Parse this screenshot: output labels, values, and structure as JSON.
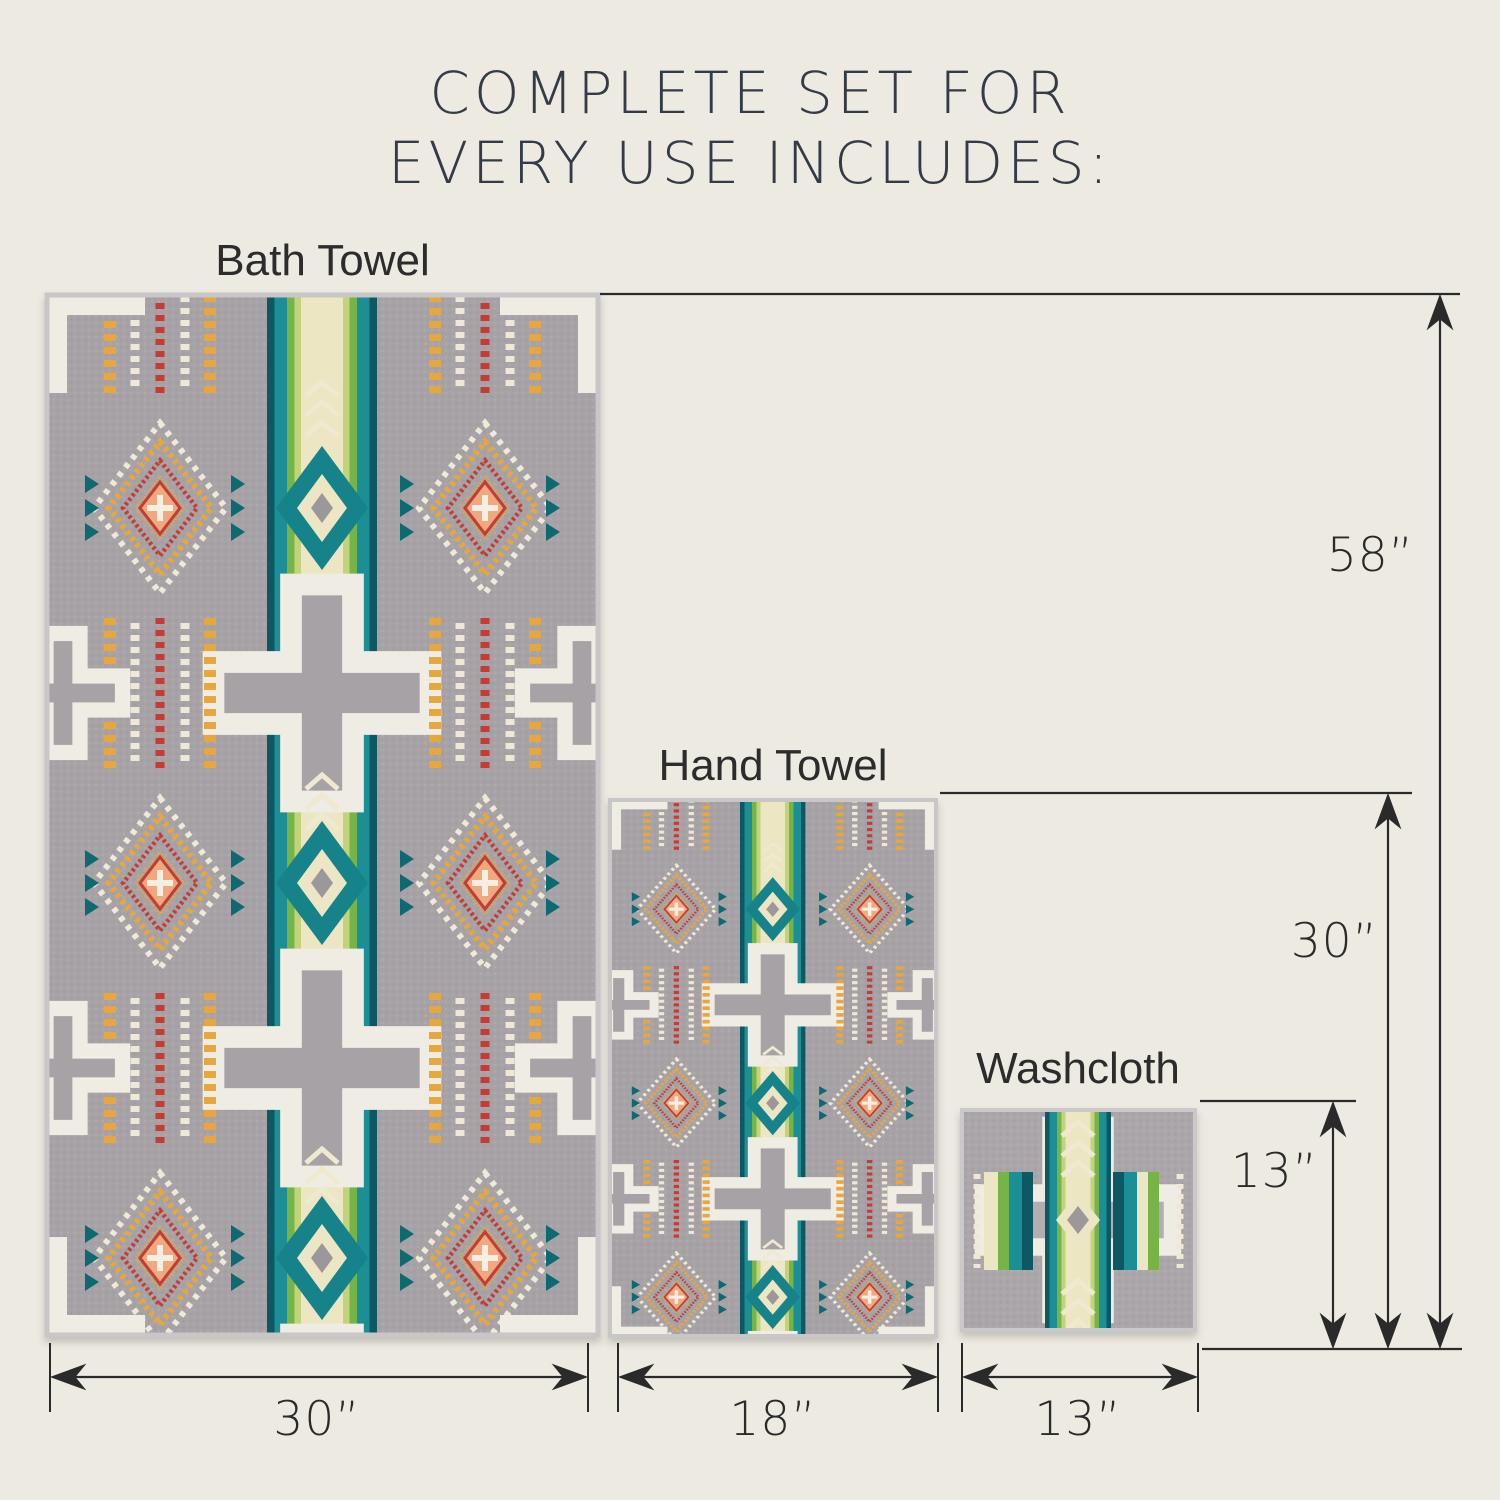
{
  "title": {
    "line1": "COMPLETE SET FOR",
    "line2": "EVERY USE INCLUDES:"
  },
  "items": [
    {
      "name": "Bath Towel",
      "width": "30”",
      "height": "58”"
    },
    {
      "name": "Hand Towel",
      "width": "18”",
      "height": "30”"
    },
    {
      "name": "Washcloth",
      "width": "13”",
      "height": "13”"
    }
  ],
  "palette": {
    "background": "#edeae1",
    "title_text": "#333c46",
    "label_text": "#2c2c2c",
    "dimension_lines": "#2a2a2a",
    "towel_grey": "#a6a2a5",
    "teal": "#1e8f96",
    "dark_teal": "#0c5962",
    "green": "#7ab647",
    "cream": "#ece6c4",
    "orange": "#e8a73d",
    "red": "#c63b30",
    "salmon": "#f0a87e",
    "white_motif": "#efece3"
  }
}
